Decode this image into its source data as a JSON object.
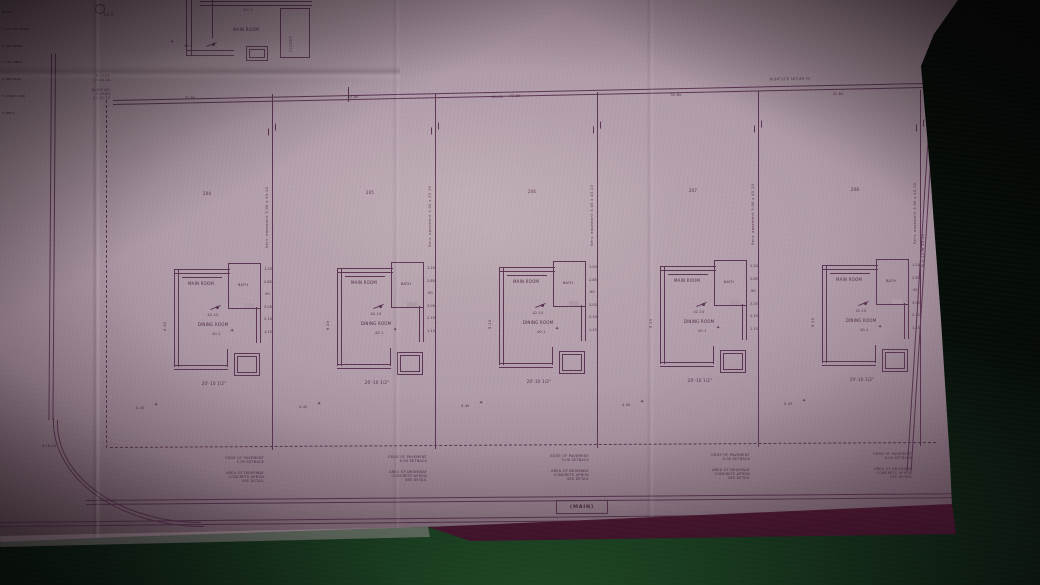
{
  "scene": {
    "description": "Photograph of an architectural site plan blueprint lying on a dark green table",
    "paper_color": "#b19daa",
    "ink_color": "#5b3553",
    "table_color": "#1d4a25",
    "fold_strip_color": "#6b2342"
  },
  "notes_column": {
    "lines": [
      "NOTES",
      "1. ALL DIM IN MTS",
      "2. SEE DETAIL",
      "3. TYP. UNITS",
      "4. REF. PLAN",
      "5. SCALE 1:100",
      "6. REV A"
    ]
  },
  "survey": {
    "top_bearing": "N 84°12'E  163.80 ml",
    "right_bearing": "N 0°12'W  45.10",
    "top_dim": "60-00",
    "lot_width_label": "32.80",
    "easement_label": "Serv. easement 3.00 x 45.10",
    "curve_note1": [
      "R=9.00",
      "L=14.14"
    ],
    "curve_note2": [
      "Δ=89°58'",
      "T=9.00",
      "C=12.72"
    ],
    "curb_radius": "R=6.00"
  },
  "street": {
    "name": "(MAIN)"
  },
  "detail_plan": {
    "room": "MAIN ROOM",
    "closet": "CLOSET",
    "dim": "30'-2",
    "circle_dim": "60.0",
    "marker": "42.0"
  },
  "unit": {
    "room_main": "MAIN ROOM",
    "room_bath": "BATH",
    "room_lower": "DINING ROOM",
    "fan_dim": "42.10",
    "spot_dim": "40.1",
    "left_dim": "9.10",
    "bottom_dim": "20'-10 1/2\"",
    "right_dims": [
      "1.20",
      "2.85",
      ".90",
      "3.05",
      "2.10",
      "1.15"
    ],
    "note_block1": [
      "EDGE OF PAVEMENT",
      "5.00 SETBACK"
    ],
    "note_block2": [
      "AREA OF DRIVEWAY",
      "CONCRETE APRON",
      "SEE DETAIL"
    ]
  },
  "lots": [
    {
      "number": "204",
      "yard_marker": "0.45"
    },
    {
      "number": "205",
      "yard_marker": "0.45"
    },
    {
      "number": "206",
      "yard_marker": "0.45"
    },
    {
      "number": "207",
      "yard_marker": "0.45"
    },
    {
      "number": "208",
      "yard_marker": "0.45"
    }
  ]
}
